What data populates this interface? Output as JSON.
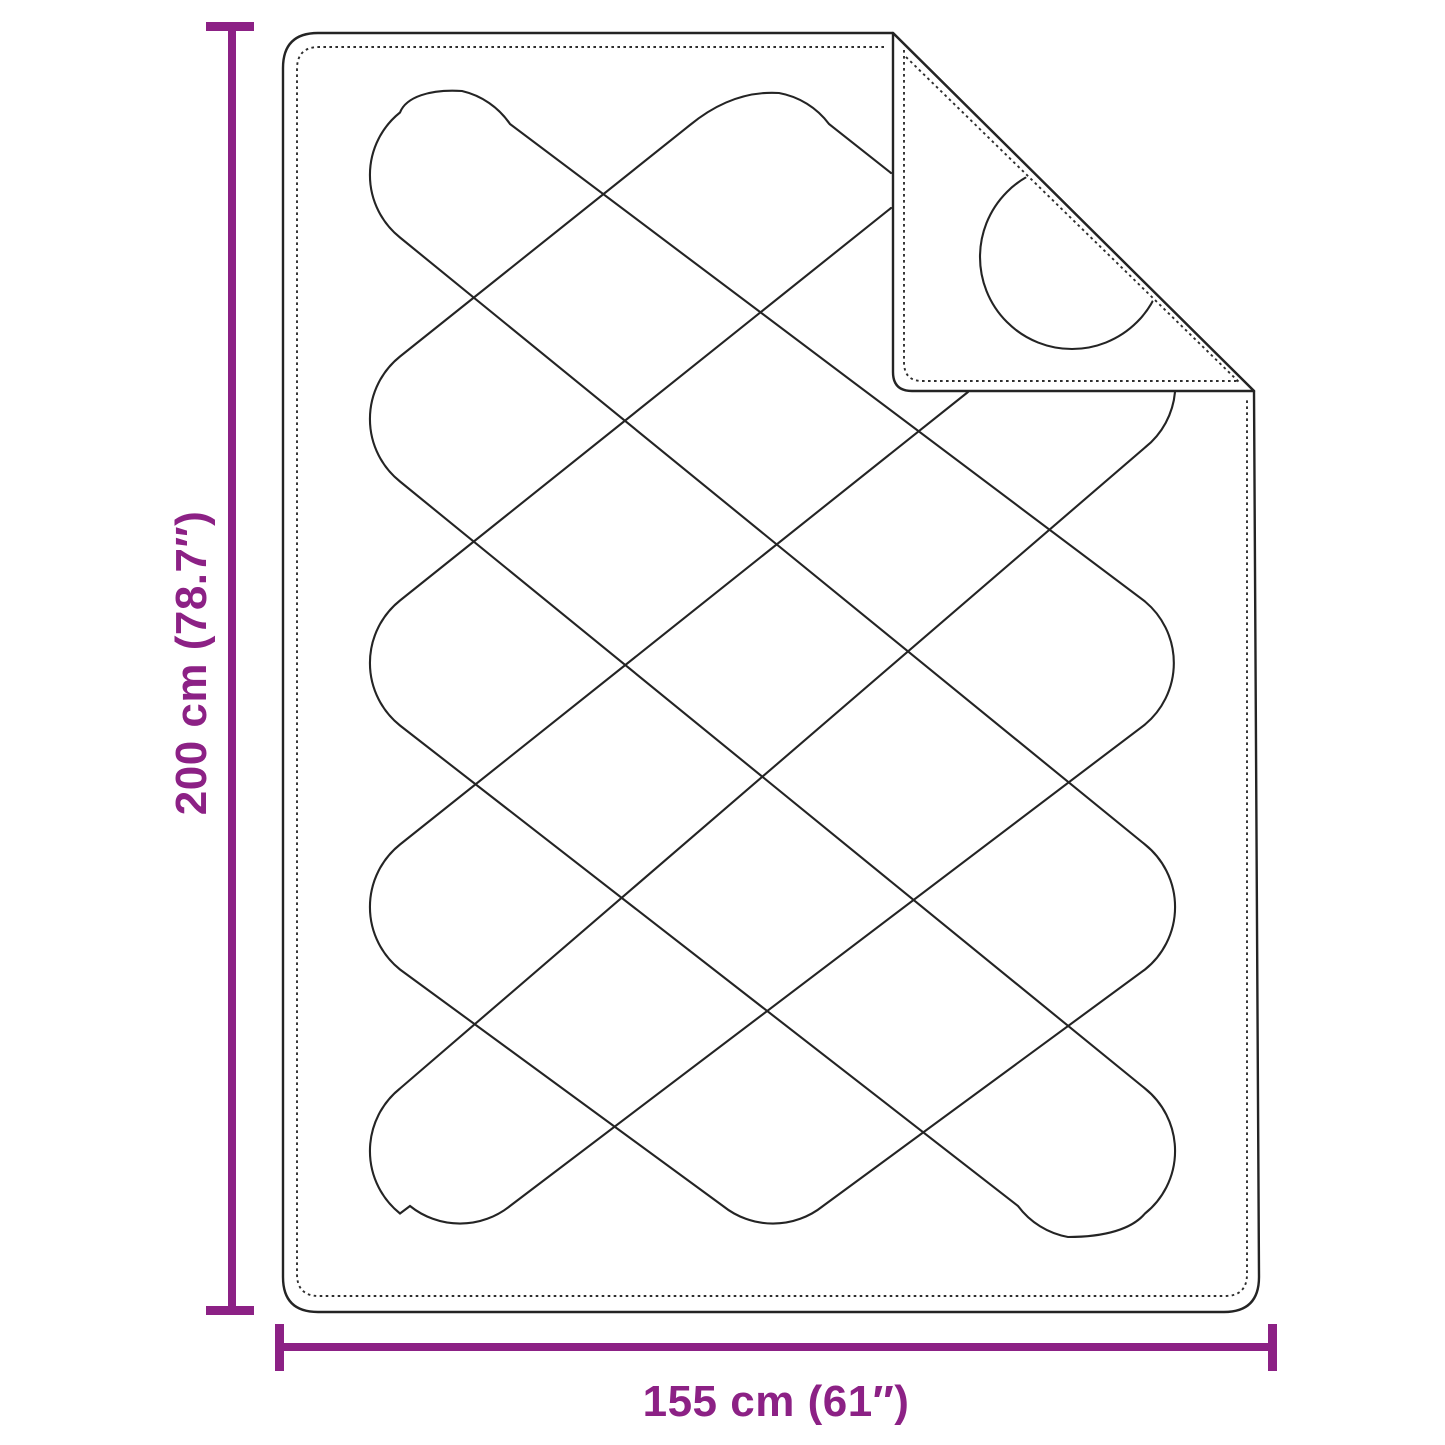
{
  "diagram": {
    "subject": "quilted blanket with folded top-right corner",
    "type": "product-dimension-diagram"
  },
  "dims": {
    "height_label": "200 cm (78.7″)",
    "width_label": "155 cm (61″)",
    "height_cm": 200,
    "height_in": 78.7,
    "width_cm": 155,
    "width_in": 61
  },
  "colors": {
    "accent": "#8C2185",
    "line": "#242424",
    "background": "#FFFFFF"
  }
}
